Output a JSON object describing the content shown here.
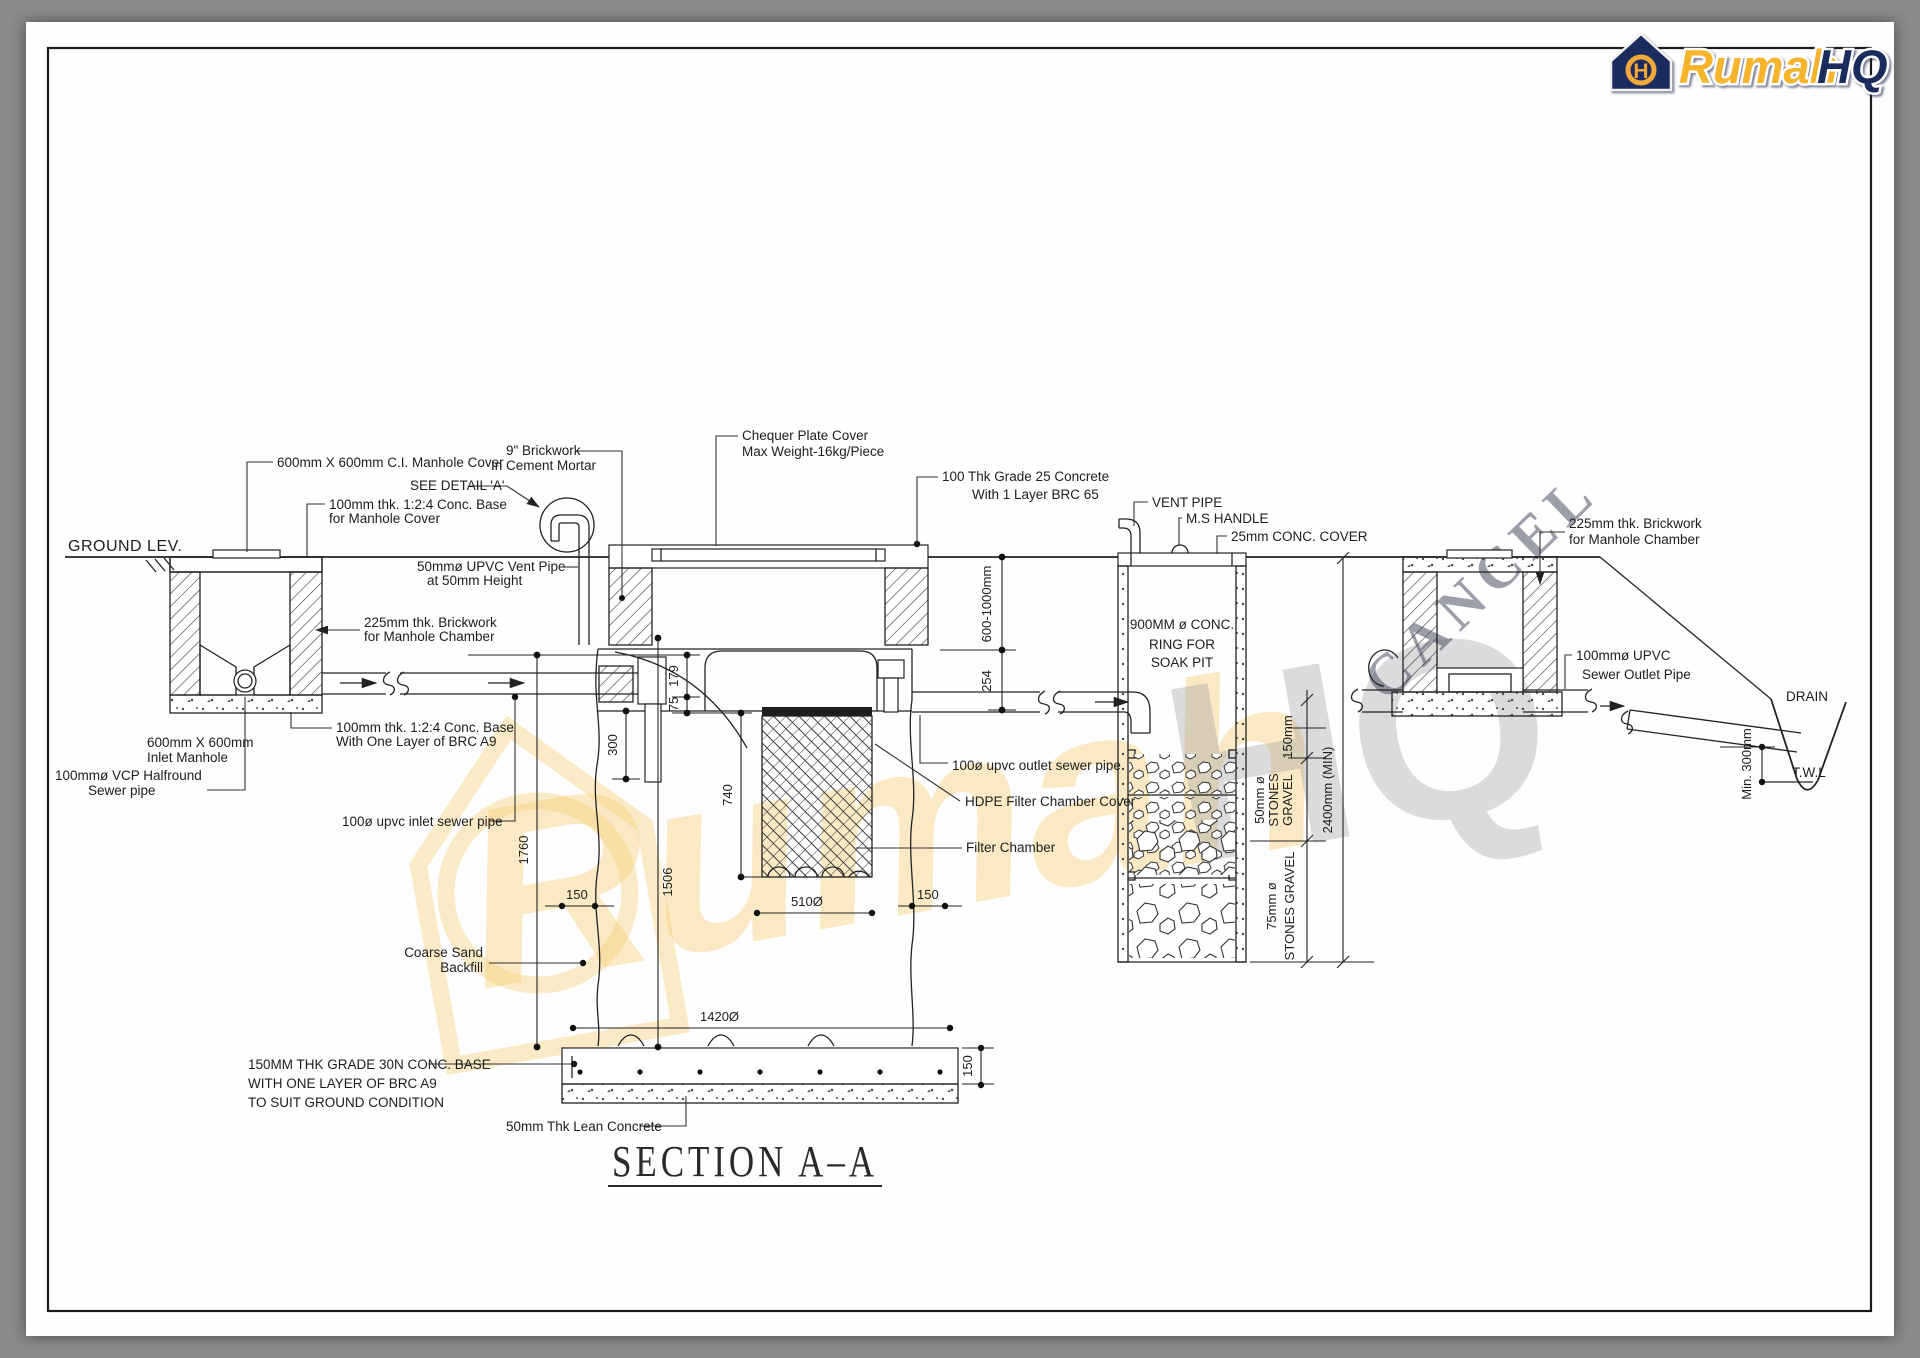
{
  "sheet": {
    "title": "SECTION  A–A",
    "ground_level_label": "GROUND LEV."
  },
  "logo": {
    "brand": "Rumah",
    "suffix": "HQ",
    "monogram": "H"
  },
  "watermark": {
    "cancel": "CANCEL",
    "brand": "Rumah",
    "suffix": "HQ"
  },
  "labels": {
    "ci_manhole_cover": [
      "600mm X 600mm C.I. Manhole Cover"
    ],
    "see_detail_a": [
      "SEE DETAIL 'A'"
    ],
    "conc_base_manhole_cover": [
      "100mm thk. 1:2:4 Conc. Base",
      "for Manhole Cover"
    ],
    "brickwork_cement_mortar": [
      "9\" Brickwork",
      "In Cement Mortar"
    ],
    "chequer_plate_cover": [
      "Chequer Plate Cover",
      "Max Weight-16kg/Piece"
    ],
    "grade25_concrete": [
      "100 Thk Grade 25 Concrete",
      "With 1 Layer BRC 65"
    ],
    "vent_pipe": [
      "VENT PIPE"
    ],
    "ms_handle": [
      "M.S HANDLE"
    ],
    "conc_cover_25mm": [
      "25mm CONC. COVER"
    ],
    "conc_ring_soak_pit": [
      "900MM ø CONC.",
      "RING FOR",
      "SOAK PIT"
    ],
    "brickwork_manhole_left": [
      "225mm thk. Brickwork",
      "for Manhole Chamber"
    ],
    "upvc_vent_pipe": [
      "50mmø UPVC Vent Pipe",
      "at 50mm Height"
    ],
    "inlet_manhole": [
      "600mm X 600mm",
      "Inlet Manhole"
    ],
    "vcp_halfround": [
      "100mmø VCP Halfround",
      "Sewer pipe"
    ],
    "conc_base_brc_a9": [
      "100mm thk. 1:2:4 Conc. Base",
      "With One Layer of BRC A9"
    ],
    "inlet_sewer_pipe": [
      "100ø upvc inlet sewer pipe"
    ],
    "outlet_sewer_pipe": [
      "100ø upvc outlet sewer pipe"
    ],
    "hdpe_cover": [
      "HDPE Filter Chamber Cover"
    ],
    "filter_chamber": [
      "Filter Chamber"
    ],
    "coarse_sand_backfill": [
      "Coarse Sand",
      "Backfill"
    ],
    "conc_base_30n": [
      "150MM THK GRADE 30N CONC. BASE",
      "WITH ONE LAYER OF BRC A9",
      "TO SUIT GROUND CONDITION"
    ],
    "lean_concrete": [
      "50mm Thk Lean Concrete"
    ],
    "brickwork_manhole_right": [
      "225mm thk. Brickwork",
      "for Manhole Chamber"
    ],
    "sewer_outlet_pipe": [
      "100mmø UPVC",
      "Sewer Outlet Pipe"
    ],
    "drain": [
      "DRAIN"
    ],
    "twl": [
      "T.W.L"
    ]
  },
  "dimensions": {
    "invert_depth": "600-1000mm",
    "d254": "254",
    "d179": "179",
    "d75": "75",
    "d300": "300",
    "d740": "740",
    "d1506": "1506",
    "d1760": "1760",
    "d150_left": "150",
    "d510": "510Ø",
    "d150_right": "150",
    "d1420": "1420Ø",
    "d150_base": "150",
    "gravel_150": "150mm",
    "gravel_50": [
      "50mm ø",
      "STONES",
      "GRAVEL"
    ],
    "gravel_75": [
      "75mm ø",
      "STONES GRAVEL"
    ],
    "pit_depth": "2400mm (MIN)",
    "min_300": "Min. 300mm"
  }
}
